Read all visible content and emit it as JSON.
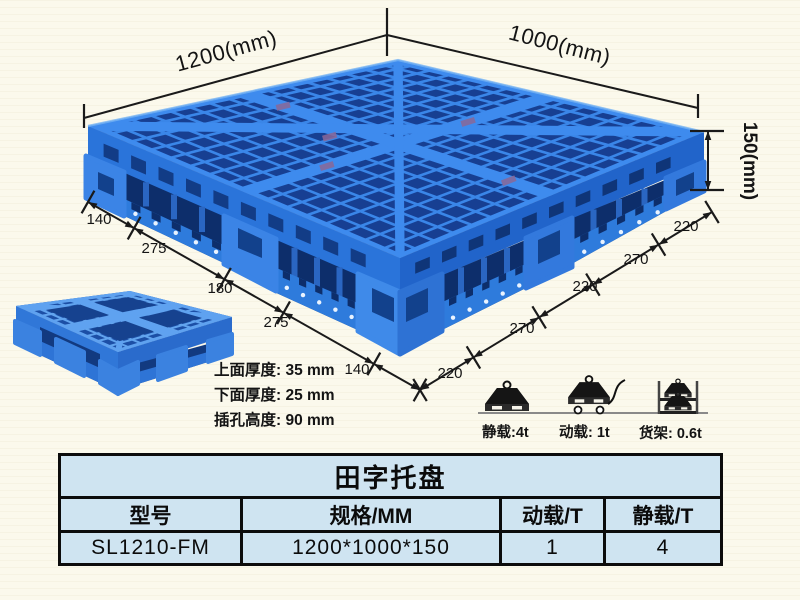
{
  "diagram": {
    "dimensions": {
      "top_left": "1200(mm)",
      "top_right": "1000(mm)",
      "height": "150(mm)",
      "left_chain": [
        "140",
        "275",
        "180",
        "275",
        "140"
      ],
      "right_chain": [
        "220",
        "270",
        "220",
        "270",
        "220"
      ]
    },
    "annotations": [
      "上面厚度: 35 mm",
      "下面厚度: 25 mm",
      "插孔高度: 90 mm"
    ],
    "load_icons": [
      {
        "icon": "static-load-weight-icon",
        "label": "静载:4t"
      },
      {
        "icon": "dynamic-load-trolley-icon",
        "label": "动载: 1t"
      },
      {
        "icon": "rack-load-shelf-icon",
        "label": "货架: 0.6t"
      }
    ],
    "colors": {
      "pallet_blue": "#2f7de2",
      "pallet_dark": "#173f92",
      "pallet_light": "#3e8bee",
      "dimension_line": "#1a1a1a"
    }
  },
  "table": {
    "title": "田字托盘",
    "headers": [
      "型号",
      "规格/MM",
      "动载/T",
      "静载/T"
    ],
    "rows": [
      [
        "SL1210-FM",
        "1200*1000*150",
        "1",
        "4"
      ]
    ],
    "cell_background": "#cfe4f1",
    "data_background": "#d9edf7"
  }
}
